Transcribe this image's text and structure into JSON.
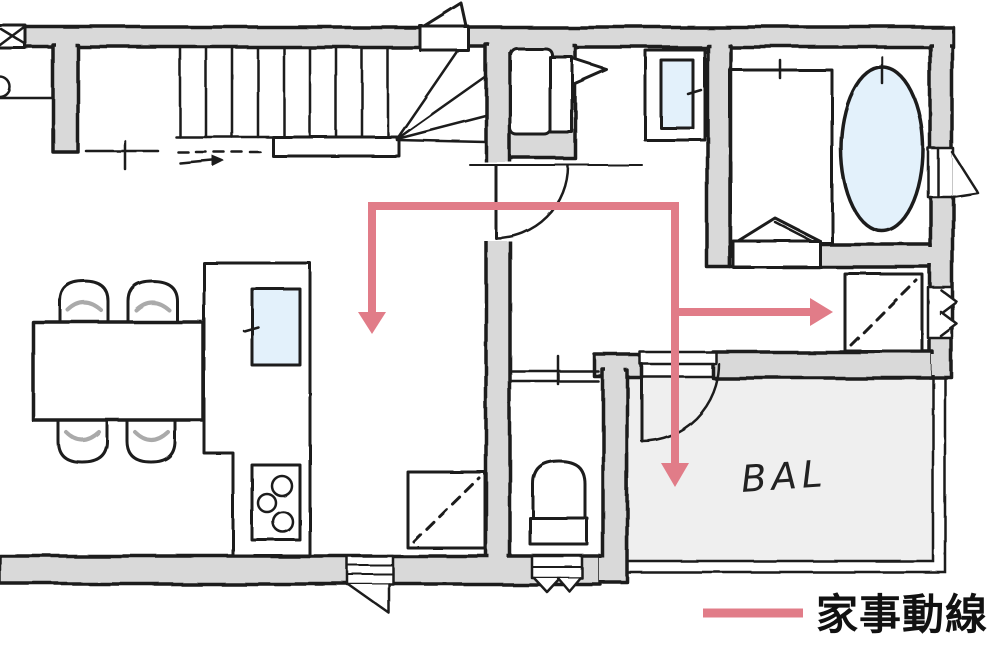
{
  "plan": {
    "balcony_label": "BAL",
    "legend_label": "家事動線",
    "colors": {
      "wall_fill": "#d9d9d9",
      "outline": "#1c1c1c",
      "water": "#e3f1fb",
      "balcony_floor": "#efefef",
      "flow_pink": "#e17c88",
      "chair_accent": "#aaaaaa"
    }
  }
}
